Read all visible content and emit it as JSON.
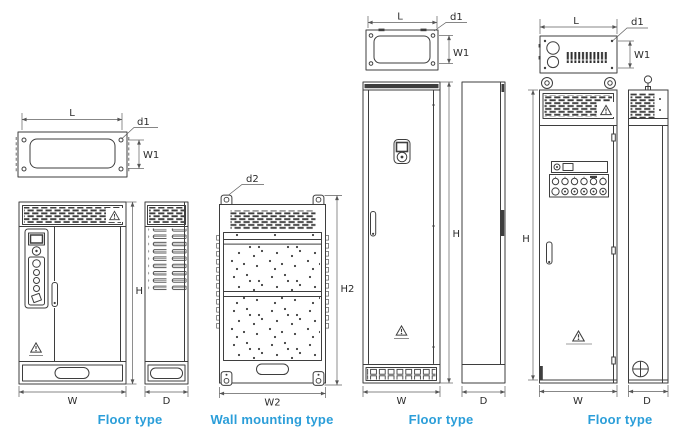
{
  "colors": {
    "accent": "#2b9ed9",
    "line": "#3e3e3e"
  },
  "groups": {
    "floor1": {
      "caption": "Floor type",
      "labels": {
        "L": "L",
        "d1": "d1",
        "W1": "W1",
        "H": "H",
        "W": "W",
        "D": "D"
      }
    },
    "wall": {
      "caption": "Wall mounting type",
      "labels": {
        "d2": "d2",
        "H2": "H2",
        "W2": "W2"
      }
    },
    "floor2": {
      "caption": "Floor type",
      "labels": {
        "L": "L",
        "d1": "d1",
        "W1": "W1",
        "H": "H",
        "W": "W",
        "D": "D"
      }
    },
    "floor3": {
      "caption": "Floor type",
      "labels": {
        "L": "L",
        "d1": "d1",
        "W1": "W1",
        "H": "H",
        "W": "W",
        "D": "D"
      }
    }
  }
}
